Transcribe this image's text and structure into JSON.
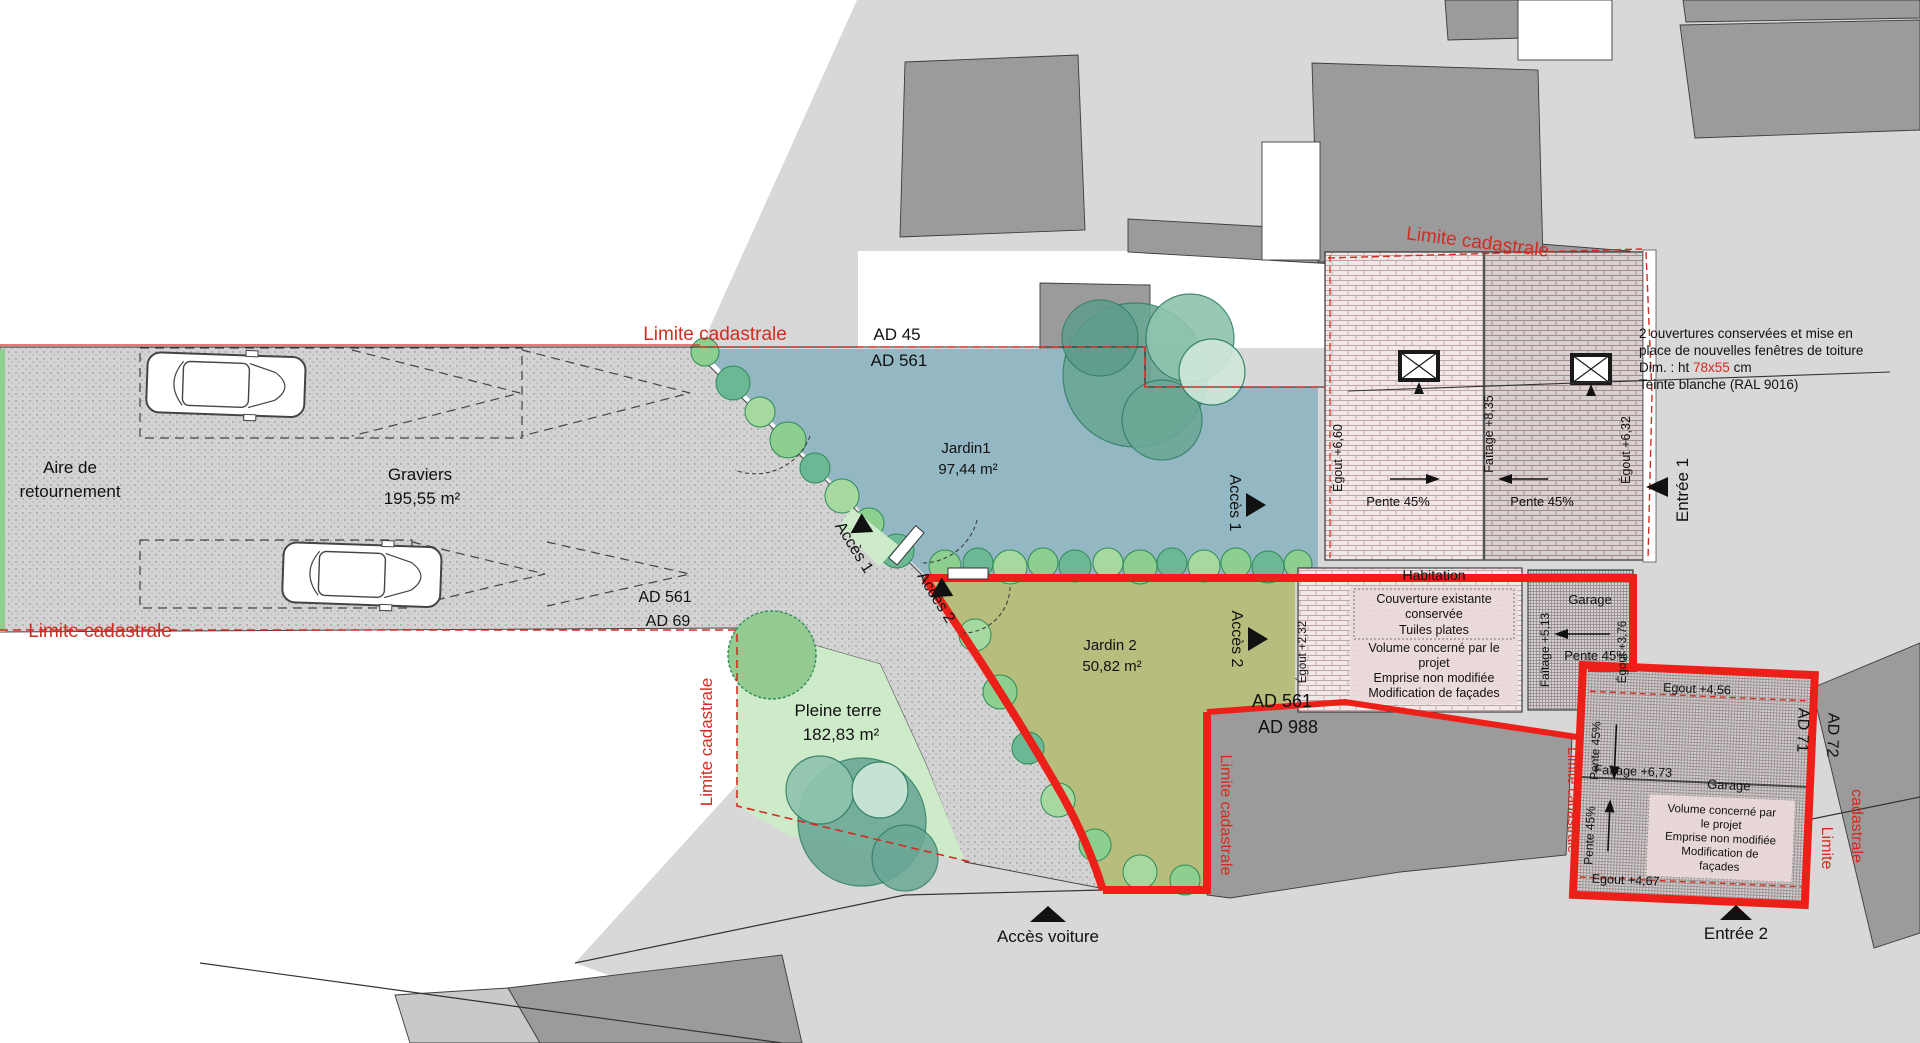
{
  "plan": {
    "title": "Plan de masse",
    "limite": "Limite cadastrale",
    "areas": {
      "aire_1": "Aire de",
      "aire_2": "retournement",
      "graviers_1": "Graviers",
      "graviers_2": "195,55 m²",
      "jardin1_1": "Jardin1",
      "jardin1_2": "97,44 m²",
      "jardin2_1": "Jardin 2",
      "jardin2_2": "50,82 m²",
      "pleine_1": "Pleine terre",
      "pleine_2": "182,83 m²"
    },
    "parcels": {
      "ad45": "AD 45",
      "ad561": "AD 561",
      "ad69": "AD 69",
      "ad988": "AD 988",
      "ad71": "AD 71",
      "ad72": "AD 72"
    },
    "access": {
      "acces1": "Accès 1",
      "acces2": "Accès 2",
      "acces_voiture": "Accès voiture",
      "entree1": "Entrée 1",
      "entree2": "Entrée 2"
    },
    "roof_main": {
      "egout_left": "Égout +6,60",
      "faitage": "Faîtage +8,35",
      "pente": "Pente 45%",
      "egout_right": "Égout +6,32"
    },
    "habitation": {
      "title": "Habitation",
      "egout": "Égout +2,32",
      "note1": [
        "Couverture existante",
        "conservée",
        "Tuiles plates"
      ],
      "note2": [
        "Volume concerné par le",
        "projet",
        "Emprise non modifiée",
        "Modification de façades"
      ]
    },
    "garage1": {
      "title": "Garage",
      "faitage": "Faîtage +5,13",
      "pente": "Pente 45%",
      "egout": "Égout +3,76"
    },
    "garage2": {
      "egout_haut": "Egout +4,56",
      "pente": "Pente 45%",
      "faitage": "Faîtage +6,73",
      "title": "Garage",
      "note": [
        "Volume concerné par",
        "le projet",
        "Emprise non modifiée",
        "Modification de",
        "façades"
      ],
      "egout_bas": "Egout +4,67"
    },
    "window_note": {
      "l1": "2 ouvertures conservées et mise en",
      "l2": "place de nouvelles fenêtres de toiture",
      "l3a": "Dim. : ht ",
      "l3b": "78x55",
      "l3c": " cm",
      "l4": "Teinte blanche (RAL 9016)"
    },
    "colors": {
      "boundary_red": "#ec2018",
      "cadastral_red": "#d42b20",
      "jardin1_blue": "#93b7c3",
      "jardin2_olive": "#b7bd7c",
      "pleine_green": "#cdebc9",
      "ground_grey": "#d8d8d8",
      "building_grey": "#9b9b9b"
    }
  }
}
